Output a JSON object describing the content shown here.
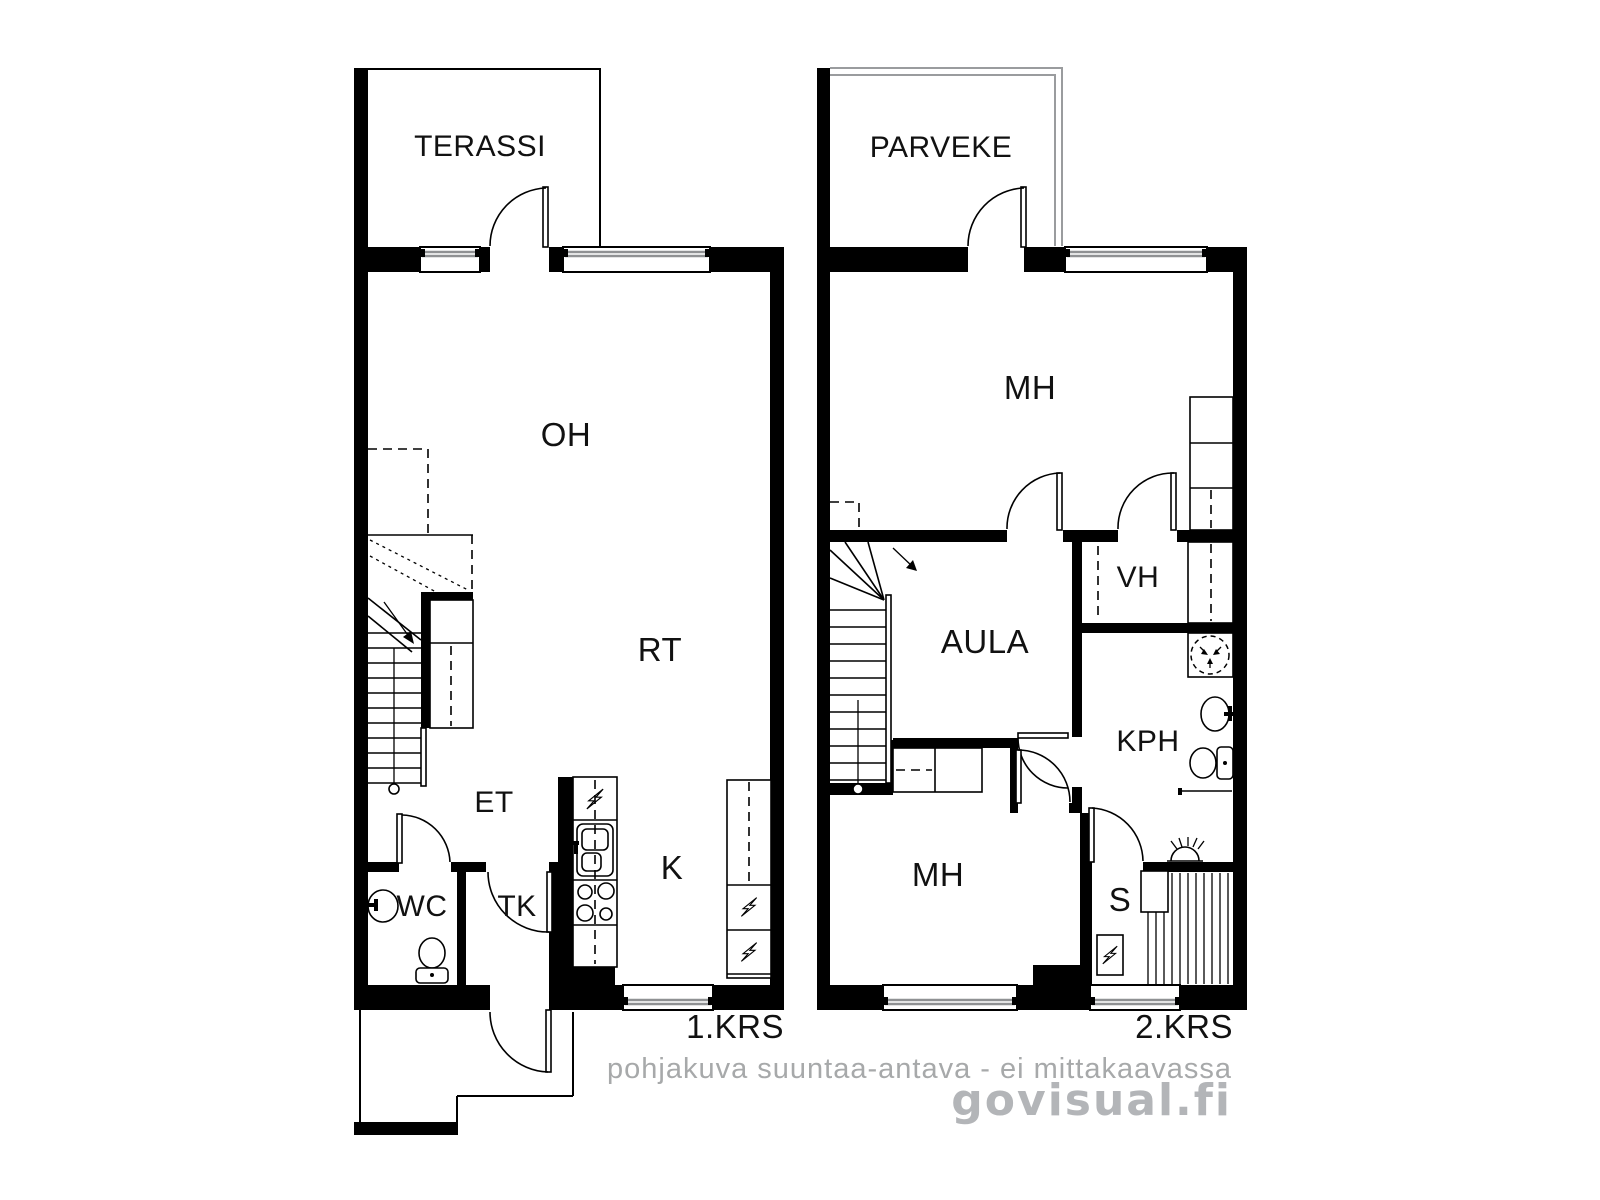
{
  "plan1": {
    "floor_label": "1.KRS",
    "rooms": {
      "terassi": "TERASSI",
      "oh": "OH",
      "rt": "RT",
      "et": "ET",
      "wc": "WC",
      "tk": "TK",
      "k": "K"
    }
  },
  "plan2": {
    "floor_label": "2.KRS",
    "rooms": {
      "parveke": "PARVEKE",
      "mh_top": "MH",
      "vh": "VH",
      "aula": "AULA",
      "kph": "KPH",
      "mh_bottom": "MH",
      "s": "S"
    }
  },
  "footer": {
    "disclaimer": "pohjakuva suuntaa-antava - ei mittakaavassa",
    "brand": "govisual.fi"
  },
  "icons": {
    "appliance": "lightning-bolt-icon",
    "sauna_stove": "lightning-bolt-icon",
    "washing_machine": "dashed-circle-arrows-icon",
    "shower": "half-dome-rays-icon",
    "toilet": "toilet-icon",
    "sink": "oval-basin-icon",
    "stove": "four-burner-icon",
    "stairs_direction": "arrow-icon"
  },
  "colors": {
    "walls": "#000000",
    "background": "#ffffff",
    "window_glass": "#8f9193",
    "balcony_outline": "#9a9c9e",
    "muted_text": "#a7a9aa",
    "brand_text": "#b3b5b8"
  }
}
